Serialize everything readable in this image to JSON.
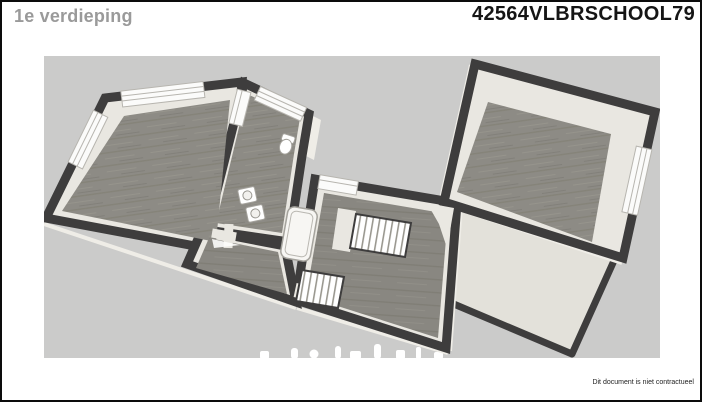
{
  "header": {
    "title": "1e verdieping",
    "code": "42564VLBRSCHOOL79"
  },
  "footer": {
    "disclaimer": "Dit document is niet contractueel"
  },
  "floorplan": {
    "type": "3d-floorplan-render",
    "floor_label": "1e verdieping",
    "colors": {
      "canvas_background": "#cbcbca",
      "walls": "#3e3d3d",
      "wood_floor": "#8d8b85",
      "wall_trim": "#e9e7e1",
      "windows": "#fbfbfa",
      "page_background": "#ffffff"
    },
    "features": [
      "large-room-with-corner-windows",
      "bathroom-with-toilet-two-sinks-bathtub",
      "roof-dormer-with-windows",
      "small-hallway-room",
      "landing-with-two-staircases",
      "separate-room-with-window",
      "flat-roof-section"
    ]
  }
}
